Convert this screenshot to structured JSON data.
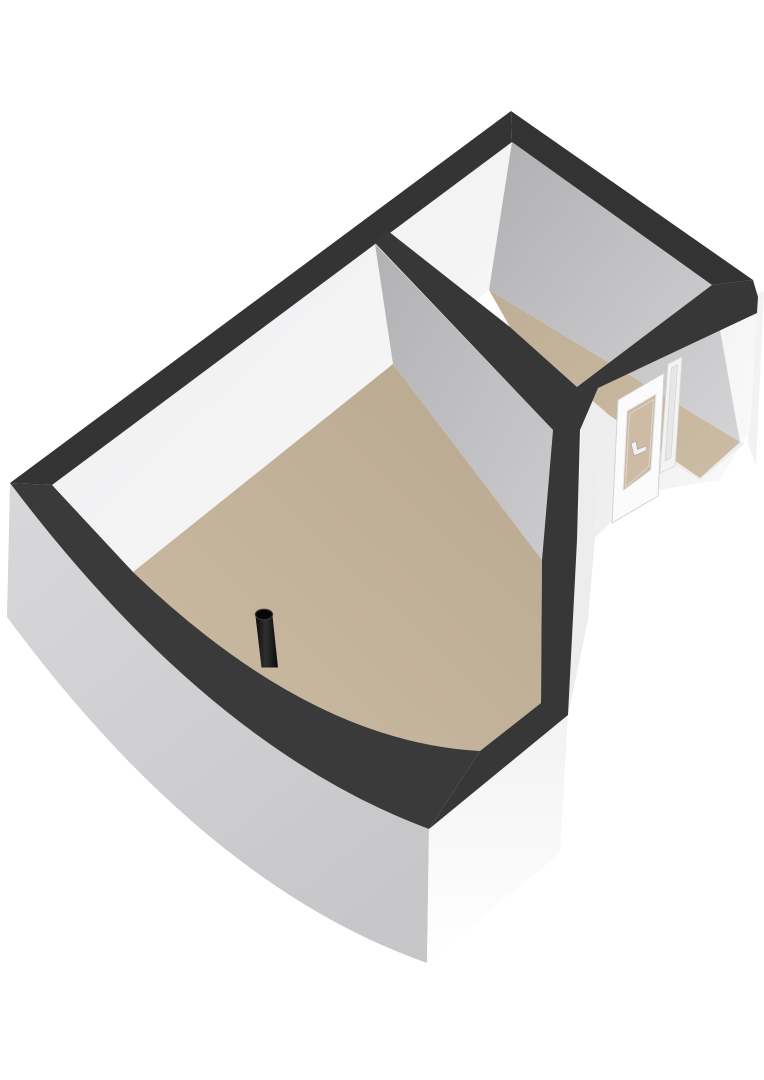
{
  "meta": {
    "kind": "floorplan-3d-render",
    "description": "Isometric-style 3D render of an L-shaped floor plan with one large room and one small room, dark wall tops, white walls, tan floors, a glazed exterior door with handle on the right wing, and a freestanding black pipe on the large room floor.",
    "canvas": {
      "width": 764,
      "height": 1080
    },
    "background": "#ffffff"
  },
  "palette": {
    "wall_top_band": "#373737",
    "wall_top_band_sw": "#3a3a3a",
    "wall_top_band_top": "#343434",
    "floor_tan": "#c3b199",
    "glass_tan": "#cdbba3",
    "interior_white": "#f1f1f1",
    "interior_gray": "#b5b5b7",
    "exterior_gray": "#cfcfd1",
    "exterior_white": "#f7f7f7",
    "door_frame": "#fbfbfb",
    "frame_stroke": "#d2d2d2",
    "handle_fill": "#f0f0f0",
    "handle_stroke": "#a0a0a0",
    "pipe_dark": "#0c0c0c",
    "pipe_highlight": "#303030"
  },
  "gradients": [
    {
      "id": "gFloorMain",
      "x1": 1,
      "y1": 0,
      "x2": 0,
      "y2": 1,
      "stops": [
        [
          "0",
          "#b9a890"
        ],
        [
          "1",
          "#ccbba3"
        ]
      ]
    },
    {
      "id": "gFloorSmall",
      "x1": 0,
      "y1": 0,
      "x2": 1,
      "y2": 1,
      "stops": [
        [
          "0",
          "#bfae96"
        ],
        [
          "1",
          "#cdbca4"
        ]
      ]
    },
    {
      "id": "gNwFace",
      "x1": 0,
      "y1": 0,
      "x2": 1,
      "y2": 1,
      "stops": [
        [
          "0",
          "#ececee"
        ],
        [
          "1",
          "#fafafa"
        ]
      ]
    },
    {
      "id": "gNeFace",
      "x1": 0,
      "y1": 0,
      "x2": 1,
      "y2": 1,
      "stops": [
        [
          "0",
          "#b0b0b2"
        ],
        [
          "1",
          "#d4d4d6"
        ]
      ]
    },
    {
      "id": "gPartFace",
      "x1": 0,
      "y1": 0,
      "x2": 1,
      "y2": 1,
      "stops": [
        [
          "0",
          "#b2b2b4"
        ],
        [
          "1",
          "#cbcbcd"
        ]
      ]
    },
    {
      "id": "gExtSW",
      "x1": 0,
      "y1": 0,
      "x2": 0.7,
      "y2": 1,
      "stops": [
        [
          "0",
          "#d8d8da"
        ],
        [
          "1",
          "#c7c7c9"
        ]
      ]
    },
    {
      "id": "gExtS",
      "x1": 0,
      "y1": 0,
      "x2": 0,
      "y2": 1,
      "stops": [
        [
          "0",
          "#f2f2f2"
        ],
        [
          "1",
          "#ffffff"
        ]
      ]
    },
    {
      "id": "gDoorWall",
      "x1": 0,
      "y1": 0,
      "x2": 1,
      "y2": 0.4,
      "stops": [
        [
          "0",
          "#eaeaea"
        ],
        [
          "1",
          "#f9f9f9"
        ]
      ]
    },
    {
      "id": "gPipe",
      "x1": 0,
      "y1": 0,
      "x2": 1,
      "y2": 0,
      "stops": [
        [
          "0",
          "#0c0c0c"
        ],
        [
          "0.45",
          "#303030"
        ],
        [
          "1",
          "#0a0a0a"
        ]
      ]
    }
  ],
  "shapes": [
    {
      "name": "exterior-wall-end-east",
      "d": "M755,295 L764,291 L756,465 L748,444 Z",
      "fill": "#f2f2f2"
    },
    {
      "name": "exterior-wall-southwest",
      "d": "M10,483 Q210,748 429,829 L427,963 Q205,885 7,617 Z",
      "fill": "g:gExtSW"
    },
    {
      "name": "exterior-wall-south",
      "d": "M429,829 L568,715 L560,853 L427,963 Z",
      "fill": "g:gExtS"
    },
    {
      "name": "exterior-wall-east-sliver",
      "d": "M582,400 L598,388 L595,538 L588,620 L568,715 L577,540 Z",
      "fill": "#ededed"
    },
    {
      "name": "door-wall-face",
      "d": "M598,388 L757,313 L750,430 L720,480 L640,493 L595,538 Z",
      "fill": "g:gDoorWall"
    },
    {
      "name": "interior-wall-northwest",
      "d": "M52,485 L512,142 L489,290 L393,364 L133,572 Z",
      "fill": "g:gNwFace"
    },
    {
      "name": "interior-wall-northeast",
      "d": "M512,142 L712,285 L740,442 L489,290 Z",
      "fill": "g:gNeFace"
    },
    {
      "name": "partition-wall-face",
      "d": "M375,244 L553,430 L542,560 L393,364 Z",
      "fill": "g:gPartFace"
    },
    {
      "name": "interior-sill-sliver",
      "d": "M605,412 L745,443 L700,480 L610,425 Z",
      "fill": "#ededed"
    },
    {
      "name": "floor-large-room",
      "d": "M133,572 L393,364 L542,560 L541,703 L480,751 Q310,742 133,572 Z",
      "fill": "g:gFloorMain"
    },
    {
      "name": "floor-small-room",
      "d": "M489,290 L740,442 L700,478 L609,415 L577,387 L510,327 Z",
      "fill": "g:gFloorSmall"
    },
    {
      "name": "wall-top-band-northwest",
      "d": "M10,483 L511,111 L512,142 L52,485 Z",
      "fill": "#343434"
    },
    {
      "name": "wall-top-band-northeast",
      "d": "M511,111 L753,280 L712,285 L512,142 Z",
      "fill": "#333333"
    },
    {
      "name": "wall-top-band-right-complex",
      "d": "M388,231 L510,327 L577,387 L712,285 L753,280 L758,297 L757,313 L598,388 L580,430 L577,540 L568,715 L429,829 L480,751 L541,703 L542,560 L553,430 L375,243 Z",
      "fill": "#373737"
    },
    {
      "name": "wall-top-band-southwest",
      "d": "M10,483 L52,485 L133,572 Q310,742 480,751 L429,829 Q210,748 10,483 Z",
      "fill": "#3a3a3a"
    },
    {
      "name": "door-frame",
      "d": "M618,400 L664,373 L658,496 L612,523 Z",
      "fill": "#fbfbfb",
      "stroke": "#d2d2d2",
      "sw": 1
    },
    {
      "name": "door-glass",
      "d": "M627,411 L656,394 L651,470 L623,491 Z",
      "fill": "#cdbba3",
      "stroke": "#e9e9e9",
      "sw": 1
    },
    {
      "name": "door-glazing-bead",
      "d": "M629.5,414 L653.5,399.5 L649,466 L625.5,487 Z",
      "fill": "none",
      "stroke": "#dcdcdc",
      "sw": 0.8
    },
    {
      "name": "door-handle",
      "d": "M631,443.5 L636,441 L637.5,449.5 L646,446 L647,450 L638.5,454 L634,455.5 Z",
      "fill": "#f0f0f0",
      "stroke": "#a0a0a0",
      "sw": 0.6
    },
    {
      "name": "door-sidelight",
      "d": "M668,364 L682,357 L675,466 L660,473 Z",
      "fill": "#f3f3f3",
      "stroke": "#dadada",
      "sw": 0.8
    },
    {
      "name": "door-sidelight-mullion",
      "d": "M671.5,368 L677.5,365 L671,458 L665,461 Z",
      "fill": "#e7e7e7",
      "stroke": "#cfcfcf",
      "sw": 0.6
    },
    {
      "name": "pipe-body",
      "d": "M255.5,616 L261.5,667.5 L278,667.5 L272.5,616 Z",
      "fill": "g:gPipe"
    },
    {
      "name": "pipe-top-opening",
      "d": "M255.4,614.5 a8.6,5.3 0 1 0 17.2,0 a8.6,5.3 0 1 0 -17.2,0 Z",
      "fill": "#060606",
      "stroke": "#3a3a3a",
      "sw": 1.2
    }
  ],
  "scene_contents": {
    "rooms": [
      {
        "name": "large-room",
        "floor": "tan",
        "walls": "white",
        "objects": [
          "black-pipe"
        ]
      },
      {
        "name": "small-room",
        "floor": "tan",
        "walls": "white-and-gray"
      }
    ],
    "objects": [
      {
        "name": "black-pipe",
        "type": "vertical-pipe",
        "color": "black",
        "location": "large-room floor near southwest wall"
      },
      {
        "name": "glazed-door",
        "type": "exterior-door",
        "glass": "tan-tinted",
        "handle": "white lever",
        "location": "southeast wall of small room",
        "sidelight": true
      }
    ]
  }
}
